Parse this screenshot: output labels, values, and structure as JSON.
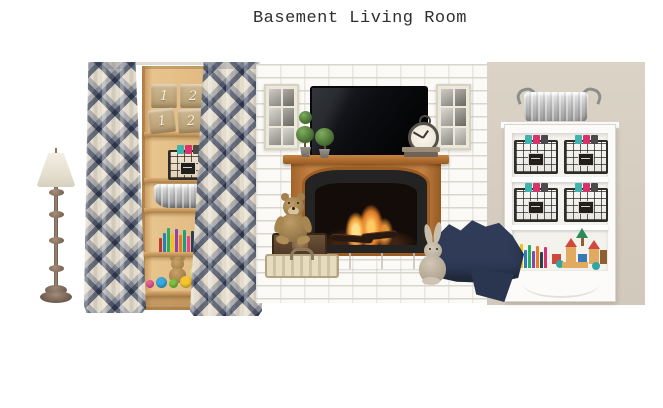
{
  "title": "Basement Living Room",
  "bins": {
    "numbers": [
      "1",
      "2",
      "1",
      "2"
    ]
  },
  "palette": {
    "background": "#ffffff",
    "beige_wall": "#d6cfc2",
    "white_brick": "#fbfaf7",
    "mortar": "#d4cfc6",
    "pine_wood": "#e0ba80",
    "mantel_wood": "#b2702f",
    "curtain_blue": "#68748f",
    "curtain_cream": "#e9e2d4",
    "navy_blanket": "#2f3b57",
    "flame_orange": "#f09a36",
    "galvanized_gray": "#bcbcbc",
    "burlap_tan": "#c2ab82",
    "teddy_brown": "#a98a58",
    "bunny_gray": "#c9bdac",
    "topiary_green": "#44682f"
  },
  "books": {
    "left_colors": [
      "#c0392b",
      "#2980b9",
      "#27ae60",
      "#f1c40f",
      "#8e44ad",
      "#e67e22",
      "#16a085",
      "#e84393",
      "#2c3e50",
      "#3498db",
      "#d35400",
      "#e74c3c"
    ],
    "right_colors": [
      "#3fb3ad",
      "#e74c3c",
      "#f1c40f",
      "#2980b9",
      "#27ae60",
      "#8e44ad",
      "#e67e22",
      "#2c3e50",
      "#d6336c"
    ]
  },
  "toys": {
    "colors": [
      "#e85a9a",
      "#3aa7dd",
      "#7bc043",
      "#f5c531",
      "#e74c3c"
    ]
  },
  "baskets": {
    "contents": [
      "#3fb3ad",
      "#d6336c",
      "#4a4a4a"
    ]
  },
  "blocks": {
    "colors": [
      "#e2aa60",
      "#cf4a3d",
      "#3a78b5",
      "#2e8b57",
      "#2fa7a0",
      "#8e5f31"
    ]
  }
}
